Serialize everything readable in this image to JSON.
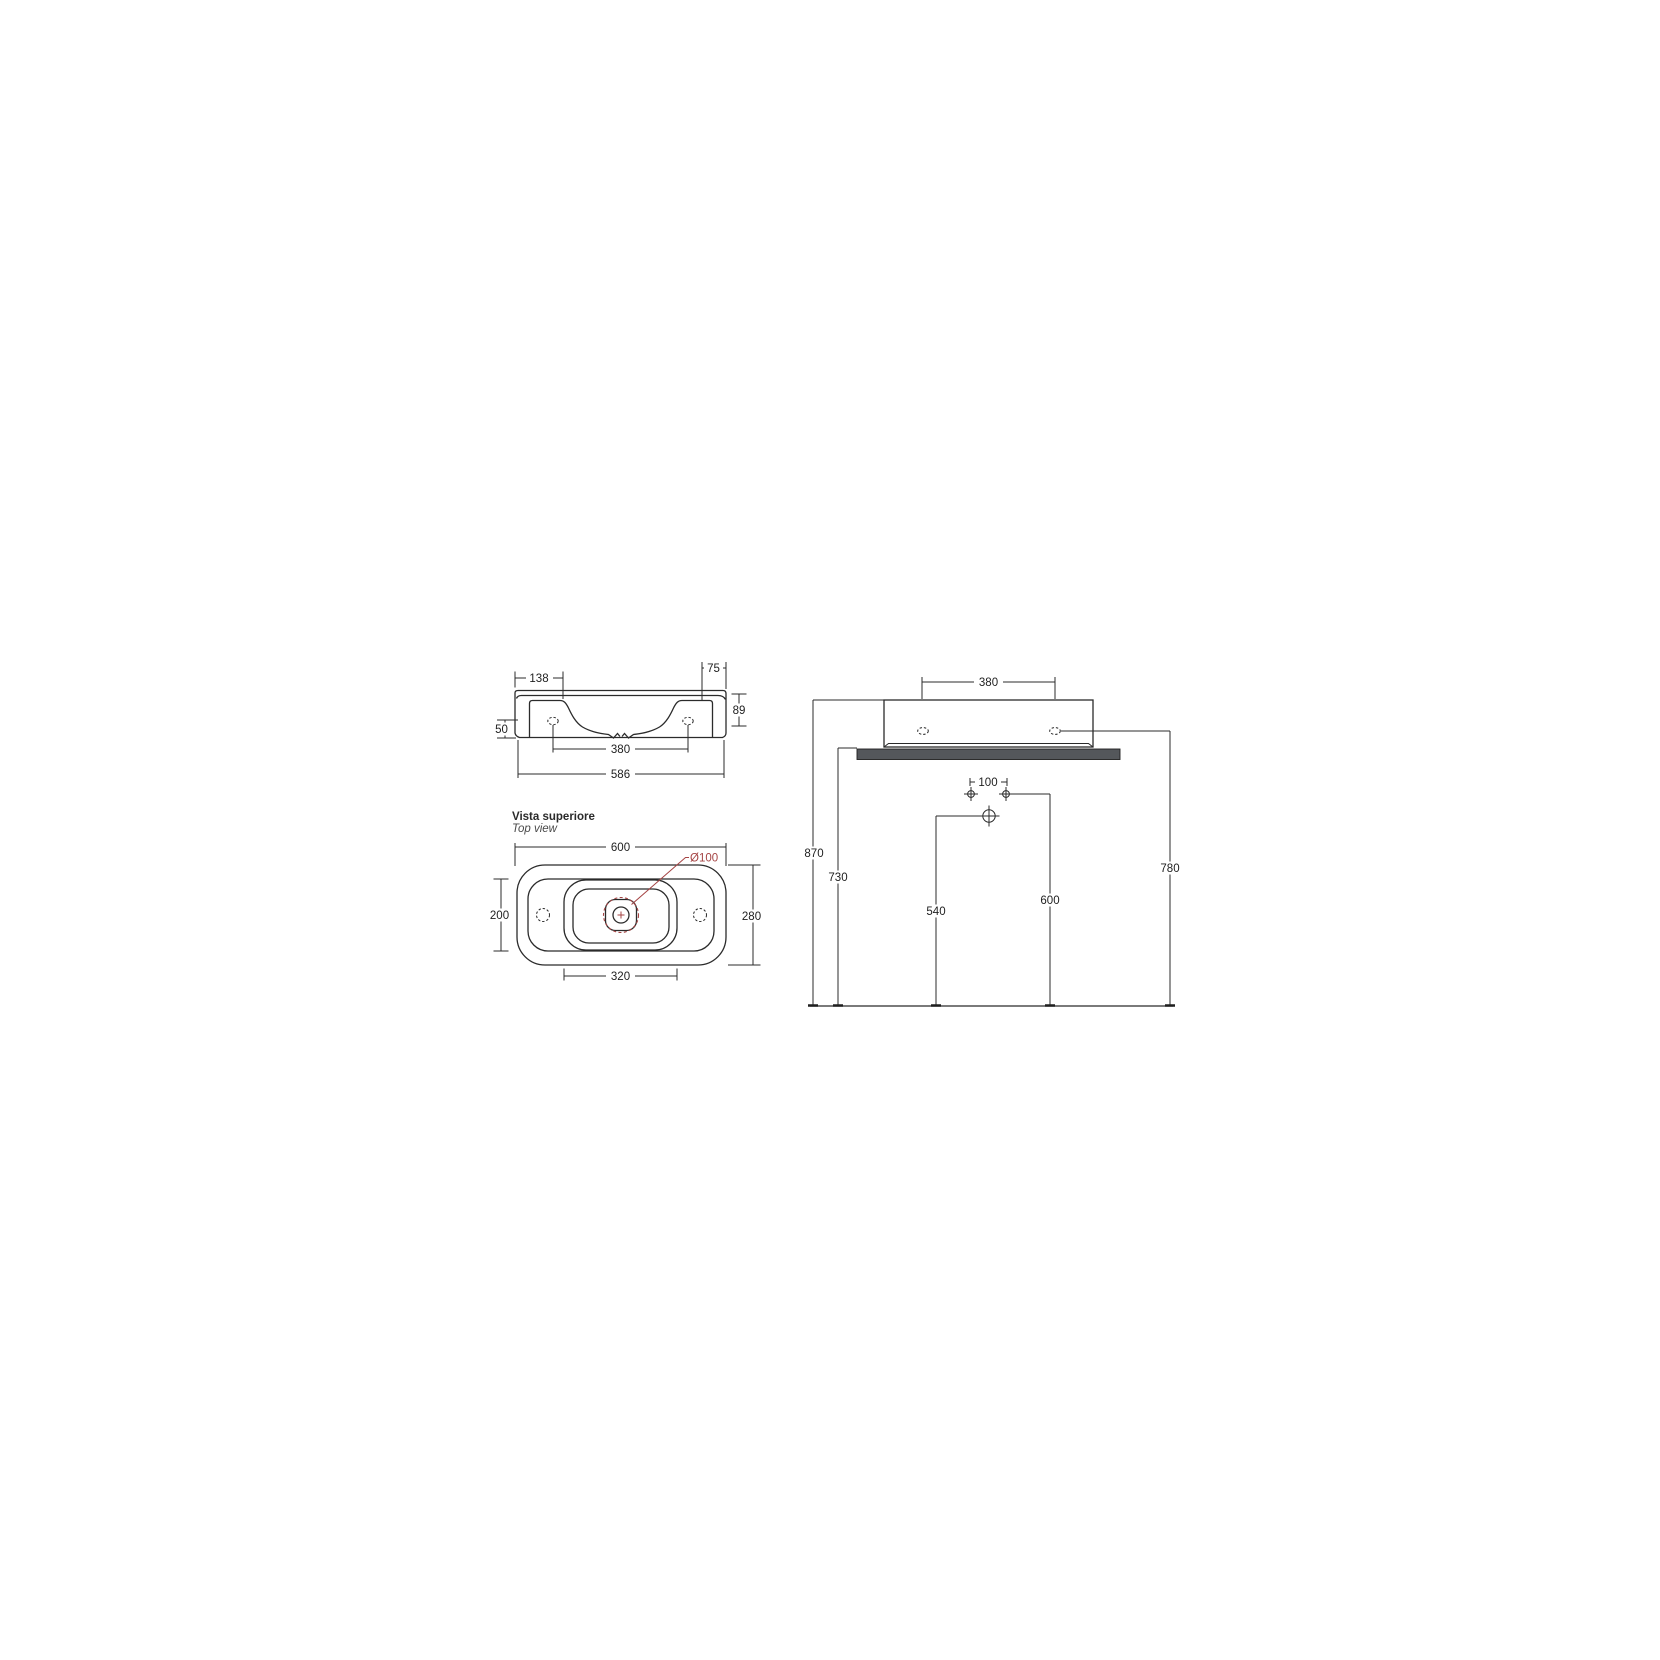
{
  "page": {
    "background": "#ffffff"
  },
  "colors": {
    "line": "#2b2b2b",
    "accent_red": "#a54444",
    "shelf_fill": "#54575b"
  },
  "front_view": {
    "dims": {
      "ledge_width": "138",
      "side_width": "75",
      "rim_height": "89",
      "hole_height": "50",
      "hole_spacing": "380",
      "overall_width": "586"
    }
  },
  "top_view": {
    "title": "Vista superiore",
    "subtitle": "Top view",
    "dims": {
      "overall_width": "600",
      "drain_diameter": "Ø100",
      "inner_depth": "200",
      "overall_depth": "280",
      "bowl_width": "320"
    }
  },
  "installation_view": {
    "dims": {
      "fixing_hole_spacing": "380",
      "supply_spacing": "100",
      "rim_height": "870",
      "shelf_height": "730",
      "drain_height": "540",
      "supply_height": "600",
      "fixing_hole_height": "780"
    }
  }
}
